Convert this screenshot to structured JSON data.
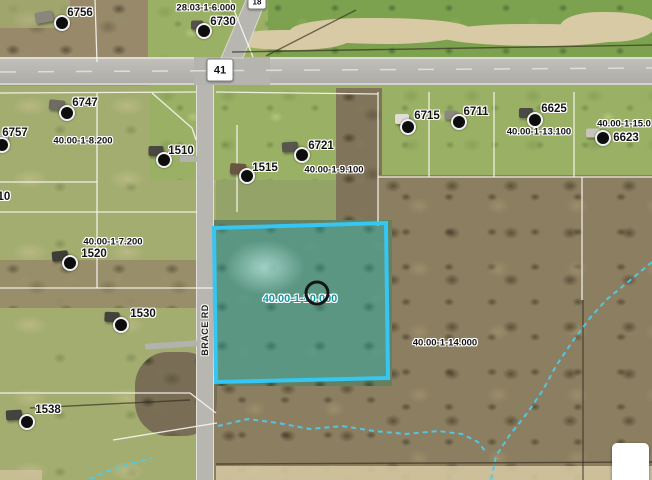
{
  "map": {
    "colors": {
      "highlight": "#35c6f3",
      "stream": "#4ecbe9",
      "selected_label": "#0c98a4"
    },
    "selected_parcel_label": {
      "text": "40.00-1-10.000",
      "x": 300,
      "y": 299
    },
    "road_name_label": {
      "text": "BRACE RD"
    },
    "road_shields": [
      {
        "text": "41",
        "x": 220,
        "y": 70,
        "w": 25,
        "h": 21
      },
      {
        "text": "18",
        "x": 257,
        "y": 2,
        "w": 17,
        "h": 13
      }
    ],
    "parcel_labels": [
      {
        "text": "6756",
        "x": 80,
        "y": 13
      },
      {
        "text": "28.03-1-6.000",
        "x": 206,
        "y": 8
      },
      {
        "text": "6730",
        "x": 223,
        "y": 22
      },
      {
        "text": "6747",
        "x": 85,
        "y": 103
      },
      {
        "text": "6757",
        "x": 15,
        "y": 133
      },
      {
        "text": "40.00-1-8.200",
        "x": 83,
        "y": 141
      },
      {
        "text": "1510",
        "x": 181,
        "y": 151
      },
      {
        "text": "6721",
        "x": 321,
        "y": 146
      },
      {
        "text": "40.00-1-9.100",
        "x": 334,
        "y": 170
      },
      {
        "text": "1515",
        "x": 265,
        "y": 168
      },
      {
        "text": "6715",
        "x": 427,
        "y": 116
      },
      {
        "text": "6711",
        "x": 476,
        "y": 112
      },
      {
        "text": "6625",
        "x": 554,
        "y": 109
      },
      {
        "text": "40.00-1-13.100",
        "x": 539,
        "y": 132
      },
      {
        "text": "40.00-1-15.0",
        "x": 624,
        "y": 124
      },
      {
        "text": "6623",
        "x": 626,
        "y": 138
      },
      {
        "text": "40.00-1-7.200",
        "x": 113,
        "y": 242
      },
      {
        "text": "1520",
        "x": 94,
        "y": 254
      },
      {
        "text": "1530",
        "x": 143,
        "y": 314
      },
      {
        "text": "110",
        "x": 1,
        "y": 197
      },
      {
        "text": "1538",
        "x": 48,
        "y": 410
      },
      {
        "text": "40.00-1-14.000",
        "x": 445,
        "y": 343
      }
    ],
    "site_markers": [
      {
        "x": 62,
        "y": 23
      },
      {
        "x": 204,
        "y": 31
      },
      {
        "x": 67,
        "y": 113
      },
      {
        "x": 2,
        "y": 145
      },
      {
        "x": 164,
        "y": 160
      },
      {
        "x": 247,
        "y": 176
      },
      {
        "x": 302,
        "y": 155
      },
      {
        "x": 408,
        "y": 127
      },
      {
        "x": 459,
        "y": 122
      },
      {
        "x": 535,
        "y": 120
      },
      {
        "x": 603,
        "y": 138
      },
      {
        "x": 70,
        "y": 263
      },
      {
        "x": 121,
        "y": 325
      },
      {
        "x": 27,
        "y": 422
      }
    ],
    "houses": [
      {
        "x": 44,
        "y": 17,
        "w": 18,
        "h": 11,
        "r": -10,
        "c": "#8a867c"
      },
      {
        "x": 197,
        "y": 25,
        "w": 12,
        "h": 9,
        "r": 0,
        "c": "#55524a"
      },
      {
        "x": 57,
        "y": 105,
        "w": 16,
        "h": 10,
        "r": 6,
        "c": "#6e6b62"
      },
      {
        "x": 2,
        "y": 138,
        "w": 12,
        "h": 9,
        "r": 0,
        "c": "#b9b6ae"
      },
      {
        "x": 156,
        "y": 151,
        "w": 15,
        "h": 10,
        "r": 0,
        "c": "#4a4842"
      },
      {
        "x": 238,
        "y": 169,
        "w": 16,
        "h": 11,
        "r": 4,
        "c": "#6a5543"
      },
      {
        "x": 290,
        "y": 147,
        "w": 16,
        "h": 10,
        "r": -4,
        "c": "#57554d"
      },
      {
        "x": 402,
        "y": 119,
        "w": 14,
        "h": 10,
        "r": 0,
        "c": "#e0ddd5"
      },
      {
        "x": 451,
        "y": 115,
        "w": 13,
        "h": 9,
        "r": 0,
        "c": "#8b8880"
      },
      {
        "x": 526,
        "y": 113,
        "w": 14,
        "h": 10,
        "r": 0,
        "c": "#4c4a44"
      },
      {
        "x": 593,
        "y": 133,
        "w": 14,
        "h": 9,
        "r": 0,
        "c": "#c7c4bc"
      },
      {
        "x": 60,
        "y": 256,
        "w": 16,
        "h": 10,
        "r": -6,
        "c": "#3f3d37"
      },
      {
        "x": 112,
        "y": 317,
        "w": 15,
        "h": 10,
        "r": 3,
        "c": "#44423c"
      },
      {
        "x": 14,
        "y": 415,
        "w": 16,
        "h": 10,
        "r": -4,
        "c": "#45433d"
      }
    ]
  },
  "controls": {
    "blank_button_label": ""
  }
}
